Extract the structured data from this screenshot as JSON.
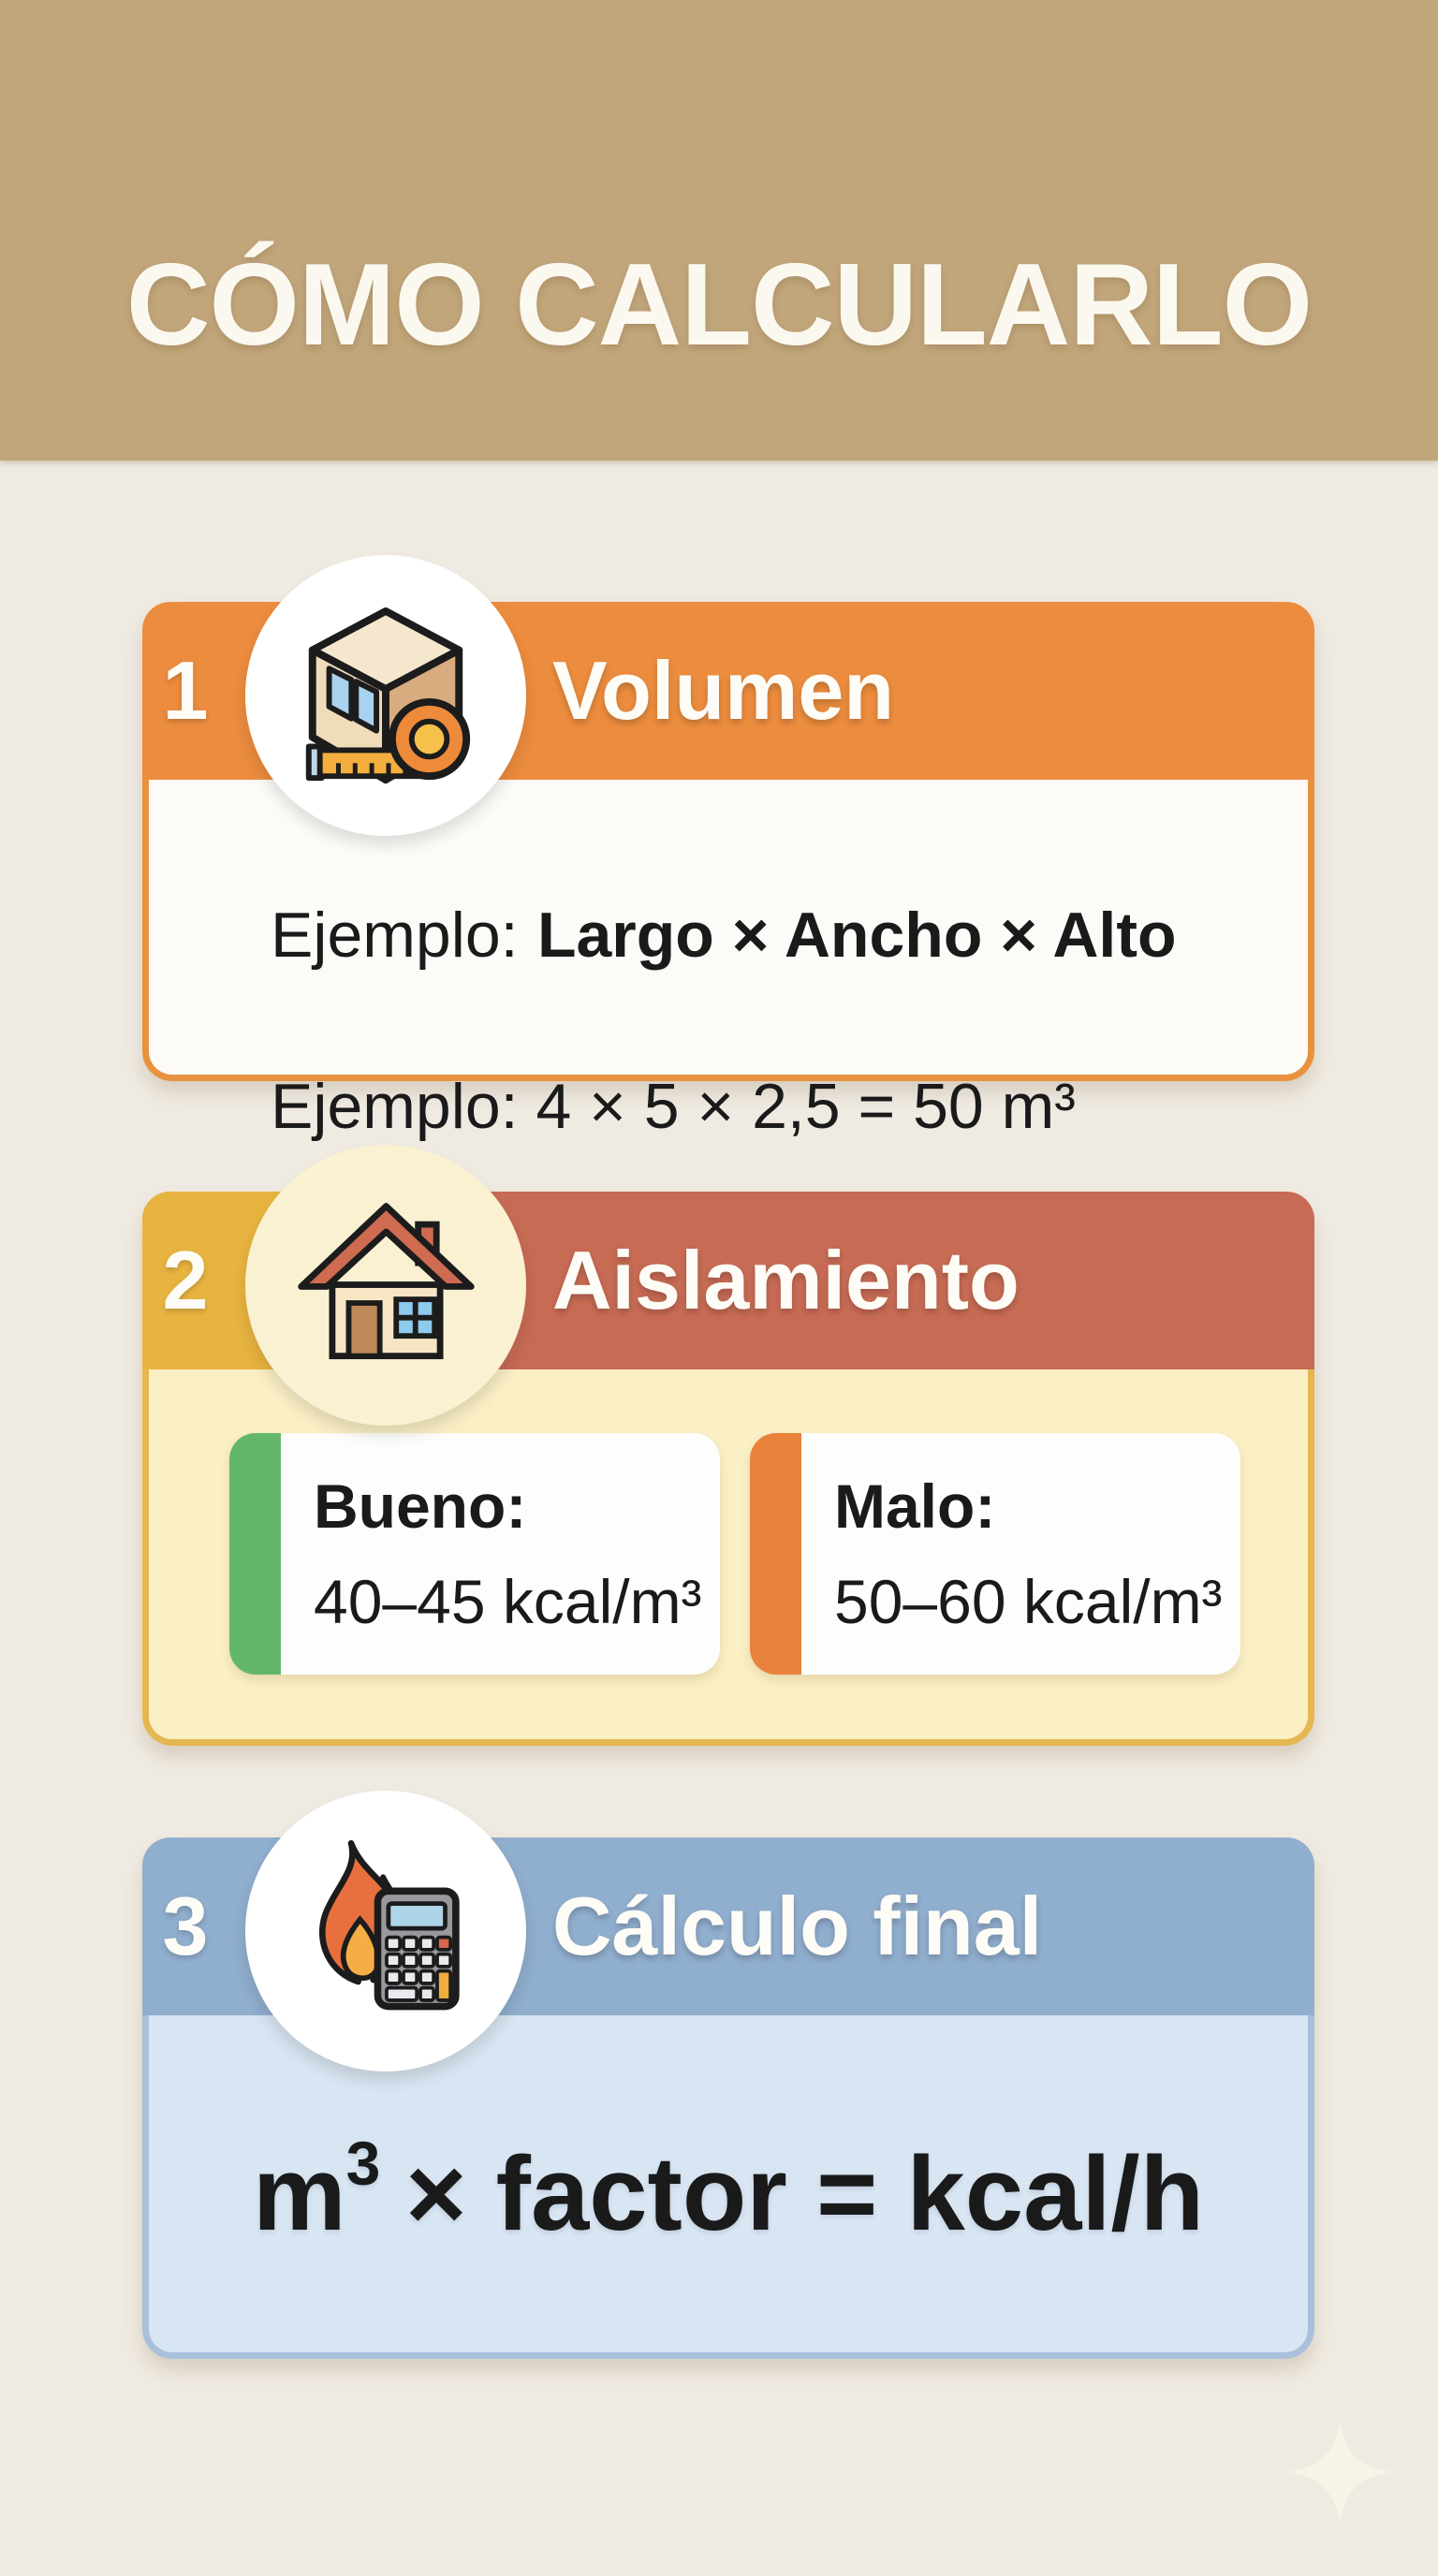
{
  "page": {
    "title": "CÓMO CALCULARLO",
    "background_color": "#F0EBE2",
    "banner_color": "#C2A67B"
  },
  "steps": [
    {
      "number": "1",
      "label": "Volumen",
      "icon": "box-with-measuring-tape-icon",
      "header_color": "#EC8C3E",
      "border_color": "#E8923F",
      "body_color": "#FDFBF7",
      "example_label": "Ejemplo:",
      "example_formula": "Largo × Ancho × Alto",
      "example_line2": "Ejemplo: 4 × 5 × 2,5 = 50 m³"
    },
    {
      "number": "2",
      "label": "Aislamiento",
      "icon": "house-icon",
      "header_color": "#C76B54",
      "number_tab_color": "#E8B440",
      "border_color": "#E5B751",
      "body_color": "#FAEFC5",
      "options": [
        {
          "title": "Bueno:",
          "value": "40–45 kcal/m³",
          "accent_color": "#63B76C"
        },
        {
          "title": "Malo:",
          "value": "50–60 kcal/m³",
          "accent_color": "#E8813A"
        }
      ]
    },
    {
      "number": "3",
      "label": "Cálculo final",
      "icon": "flame-and-calculator-icon",
      "header_color": "#90AECE",
      "border_color": "#A8C0DB",
      "body_color": "#D8E5F2",
      "formula": {
        "base": "m",
        "exponent": "3",
        "rest": "× factor = kcal/h"
      }
    }
  ],
  "decoration": {
    "sparkle": "sparkle-icon"
  }
}
